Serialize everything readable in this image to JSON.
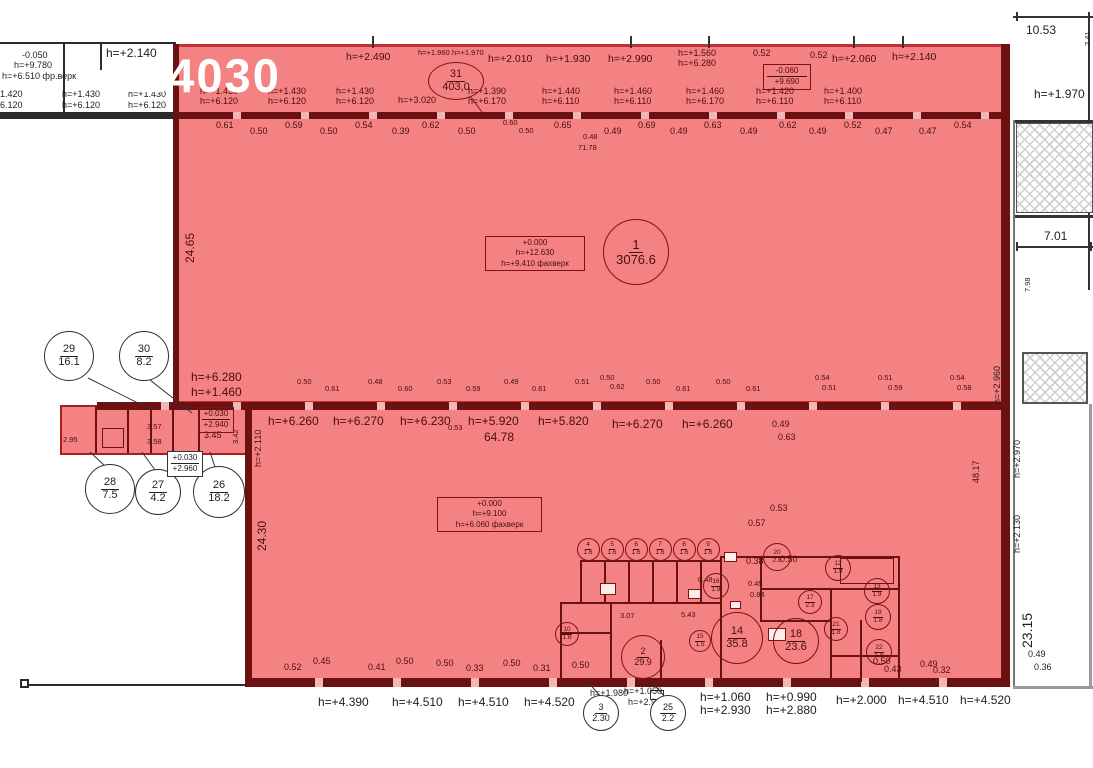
{
  "watermark": "224030",
  "colors": {
    "red_fill": "#f58282",
    "red_border": "#c43030",
    "wall_maroon": "#6b1111",
    "line_black": "#2b2b2b",
    "white": "#ffffff"
  },
  "rooms": [
    {
      "n": "31",
      "a": "403,0",
      "cx": 456,
      "cy": 81,
      "w": 56,
      "h": 38,
      "th": "r",
      "fs": "f11"
    },
    {
      "n": "1",
      "a": "3076.6",
      "cx": 636,
      "cy": 252,
      "w": 66,
      "h": 66,
      "th": "r",
      "fs": "f13"
    },
    {
      "n": "29",
      "a": "16.1",
      "cx": 69,
      "cy": 356,
      "w": 50,
      "h": 50,
      "th": "k",
      "fs": "f11"
    },
    {
      "n": "30",
      "a": "8.2",
      "cx": 144,
      "cy": 356,
      "w": 50,
      "h": 50,
      "th": "k",
      "fs": "f11"
    },
    {
      "n": "28",
      "a": "7.5",
      "cx": 110,
      "cy": 489,
      "w": 50,
      "h": 50,
      "th": "k",
      "fs": "f11"
    },
    {
      "n": "27",
      "a": "4.2",
      "cx": 158,
      "cy": 492,
      "w": 46,
      "h": 46,
      "th": "k",
      "fs": "f11"
    },
    {
      "n": "26",
      "a": "18.2",
      "cx": 219,
      "cy": 492,
      "w": 52,
      "h": 52,
      "th": "k",
      "fs": "f11"
    },
    {
      "n": "2",
      "a": "29.9",
      "cx": 643,
      "cy": 657,
      "w": 44,
      "h": 44,
      "th": "r",
      "fs": "f9"
    },
    {
      "n": "3",
      "a": "2.30",
      "cx": 601,
      "cy": 713,
      "w": 36,
      "h": 36,
      "th": "k",
      "fs": "f9"
    },
    {
      "n": "25",
      "a": "2.2",
      "cx": 668,
      "cy": 713,
      "w": 36,
      "h": 36,
      "th": "k",
      "fs": "f9"
    },
    {
      "n": "4",
      "a": "1.6",
      "cx": 588,
      "cy": 549,
      "w": 23,
      "h": 23,
      "th": "r",
      "fs": "f6"
    },
    {
      "n": "5",
      "a": "1.6",
      "cx": 612,
      "cy": 549,
      "w": 23,
      "h": 23,
      "th": "r",
      "fs": "f6"
    },
    {
      "n": "6",
      "a": "1.6",
      "cx": 636,
      "cy": 549,
      "w": 23,
      "h": 23,
      "th": "r",
      "fs": "f6"
    },
    {
      "n": "7",
      "a": "1.6",
      "cx": 660,
      "cy": 549,
      "w": 23,
      "h": 23,
      "th": "r",
      "fs": "f6"
    },
    {
      "n": "8",
      "a": "1.6",
      "cx": 684,
      "cy": 549,
      "w": 23,
      "h": 23,
      "th": "r",
      "fs": "f6"
    },
    {
      "n": "9",
      "a": "1.6",
      "cx": 708,
      "cy": 549,
      "w": 23,
      "h": 23,
      "th": "r",
      "fs": "f6"
    },
    {
      "n": "10",
      "a": "1.6",
      "cx": 567,
      "cy": 634,
      "w": 24,
      "h": 24,
      "th": "r",
      "fs": "f6"
    },
    {
      "n": "16",
      "a": "1.9",
      "cx": 716,
      "cy": 586,
      "w": 26,
      "h": 26,
      "th": "r",
      "fs": "f6"
    },
    {
      "n": "20",
      "a": "2.8",
      "cx": 777,
      "cy": 557,
      "w": 28,
      "h": 28,
      "th": "r",
      "fs": "f6"
    },
    {
      "n": "12",
      "a": "1.9",
      "cx": 838,
      "cy": 568,
      "w": 26,
      "h": 26,
      "th": "r",
      "fs": "f6"
    },
    {
      "n": "13",
      "a": "1.9",
      "cx": 877,
      "cy": 591,
      "w": 26,
      "h": 26,
      "th": "r",
      "fs": "f6"
    },
    {
      "n": "17",
      "a": "2.3",
      "cx": 810,
      "cy": 602,
      "w": 24,
      "h": 24,
      "th": "r",
      "fs": "f6"
    },
    {
      "n": "19",
      "a": "1.8",
      "cx": 878,
      "cy": 617,
      "w": 26,
      "h": 26,
      "th": "r",
      "fs": "f6"
    },
    {
      "n": "21",
      "a": "1.8",
      "cx": 836,
      "cy": 629,
      "w": 24,
      "h": 24,
      "th": "r",
      "fs": "f6"
    },
    {
      "n": "14",
      "a": "35.8",
      "cx": 737,
      "cy": 638,
      "w": 52,
      "h": 52,
      "th": "r",
      "fs": "f11"
    },
    {
      "n": "18",
      "a": "23.6",
      "cx": 796,
      "cy": 641,
      "w": 46,
      "h": 46,
      "th": "r",
      "fs": "f11"
    },
    {
      "n": "15",
      "a": "1.5",
      "cx": 700,
      "cy": 641,
      "w": 22,
      "h": 22,
      "th": "r",
      "fs": "f6"
    },
    {
      "n": "22",
      "a": "1.8",
      "cx": 879,
      "cy": 652,
      "w": 26,
      "h": 26,
      "th": "r",
      "fs": "f6"
    }
  ],
  "tag_boxes": [
    {
      "lines": [
        "+0.000",
        "h=+12.630",
        "h=+9.410 фахверк"
      ],
      "x": 485,
      "y": 236,
      "w": 100,
      "th": "r",
      "divided": false
    },
    {
      "lines": [
        "+0.000",
        "h=+9.100",
        "h=+6.060 фахверк"
      ],
      "x": 437,
      "y": 497,
      "w": 105,
      "th": "r",
      "divided": false
    },
    {
      "lines": [
        "-0.060",
        "+9.690"
      ],
      "x": 763,
      "y": 64,
      "w": 48,
      "th": "r",
      "divided": true
    },
    {
      "lines": [
        "+0.030",
        "+2.940"
      ],
      "x": 198,
      "y": 407,
      "w": 36,
      "th": "r",
      "divided": true
    },
    {
      "lines": [
        "+0.030",
        "+2.960"
      ],
      "x": 167,
      "y": 451,
      "w": 36,
      "th": "k",
      "divided": true
    }
  ],
  "annotations": [
    {
      "t": "-0.050",
      "x": 22,
      "y": 51,
      "c": "k",
      "s": "sm"
    },
    {
      "t": "h=+9.780",
      "x": 14,
      "y": 61,
      "c": "k",
      "s": "sm"
    },
    {
      "t": "h=+6.510 фр.верк",
      "x": 2,
      "y": 72,
      "c": "k",
      "s": "sm"
    },
    {
      "t": "h=+2.140",
      "x": 106,
      "y": 47,
      "c": "k",
      "s": "md"
    },
    {
      "t": "1.420",
      "x": 0,
      "y": 90,
      "c": "k",
      "s": "sm"
    },
    {
      "t": "6.120",
      "x": 0,
      "y": 101,
      "c": "k",
      "s": "sm"
    },
    {
      "t": "h=+1.430",
      "x": 62,
      "y": 90,
      "c": "k",
      "s": "sm"
    },
    {
      "t": "h=+6.120",
      "x": 62,
      "y": 101,
      "c": "k",
      "s": "sm"
    },
    {
      "t": "h=+1.430",
      "x": 128,
      "y": 90,
      "c": "k",
      "s": "sm"
    },
    {
      "t": "h=+6.120",
      "x": 128,
      "y": 101,
      "c": "k",
      "s": "sm"
    },
    {
      "t": "h=+2.490",
      "x": 346,
      "y": 52
    },
    {
      "t": "h=+1.960",
      "x": 418,
      "y": 49,
      "s": "xs"
    },
    {
      "t": "h=+1.970",
      "x": 452,
      "y": 49,
      "s": "xs"
    },
    {
      "t": "h=+2.010",
      "x": 488,
      "y": 54
    },
    {
      "t": "h=+1.930",
      "x": 546,
      "y": 54
    },
    {
      "t": "h=+2.990",
      "x": 608,
      "y": 54
    },
    {
      "t": "h=+1.560",
      "x": 678,
      "y": 49,
      "s": "sm"
    },
    {
      "t": "h=+6.280",
      "x": 678,
      "y": 59,
      "s": "sm"
    },
    {
      "t": "0.52",
      "x": 753,
      "y": 49,
      "s": "sm"
    },
    {
      "t": "0.52",
      "x": 810,
      "y": 51,
      "s": "sm"
    },
    {
      "t": "h=+2.060",
      "x": 832,
      "y": 54
    },
    {
      "t": "h=+2.140",
      "x": 892,
      "y": 52
    },
    {
      "t": "h=+1.430",
      "x": 200,
      "y": 87,
      "s": "sm"
    },
    {
      "t": "h=+6.120",
      "x": 200,
      "y": 97,
      "s": "sm"
    },
    {
      "t": "h=+1.430",
      "x": 268,
      "y": 87,
      "s": "sm"
    },
    {
      "t": "h=+6.120",
      "x": 268,
      "y": 97,
      "s": "sm"
    },
    {
      "t": "h=+1.430",
      "x": 336,
      "y": 87,
      "s": "sm"
    },
    {
      "t": "h=+6.120",
      "x": 336,
      "y": 97,
      "s": "sm"
    },
    {
      "t": "h=+3.020",
      "x": 398,
      "y": 96,
      "s": "sm"
    },
    {
      "t": "h=+1.390",
      "x": 468,
      "y": 87,
      "s": "sm"
    },
    {
      "t": "h=+6.170",
      "x": 468,
      "y": 97,
      "s": "sm"
    },
    {
      "t": "h=+1.440",
      "x": 542,
      "y": 87,
      "s": "sm"
    },
    {
      "t": "h=+6.110",
      "x": 542,
      "y": 97,
      "s": "sm"
    },
    {
      "t": "h=+1.460",
      "x": 614,
      "y": 87,
      "s": "sm"
    },
    {
      "t": "h=+6.110",
      "x": 614,
      "y": 97,
      "s": "sm"
    },
    {
      "t": "h=+1.460",
      "x": 686,
      "y": 87,
      "s": "sm"
    },
    {
      "t": "h=+6.170",
      "x": 686,
      "y": 97,
      "s": "sm"
    },
    {
      "t": "h=+1.420",
      "x": 756,
      "y": 87,
      "s": "sm"
    },
    {
      "t": "h=+6.110",
      "x": 756,
      "y": 97,
      "s": "sm"
    },
    {
      "t": "h=+1.400",
      "x": 824,
      "y": 87,
      "s": "sm"
    },
    {
      "t": "h=+6.110",
      "x": 824,
      "y": 97,
      "s": "sm"
    },
    {
      "t": "0.61",
      "x": 216,
      "y": 121,
      "s": "sm"
    },
    {
      "t": "0.50",
      "x": 250,
      "y": 127,
      "s": "sm"
    },
    {
      "t": "0.59",
      "x": 285,
      "y": 121,
      "s": "sm"
    },
    {
      "t": "0.50",
      "x": 320,
      "y": 127,
      "s": "sm"
    },
    {
      "t": "0.54",
      "x": 355,
      "y": 121,
      "s": "sm"
    },
    {
      "t": "0.39",
      "x": 392,
      "y": 127,
      "s": "sm"
    },
    {
      "t": "0.62",
      "x": 422,
      "y": 121,
      "s": "sm"
    },
    {
      "t": "0.50",
      "x": 458,
      "y": 127,
      "s": "sm"
    },
    {
      "t": "0.60",
      "x": 503,
      "y": 119,
      "s": "xs"
    },
    {
      "t": "0.50",
      "x": 519,
      "y": 127,
      "s": "xs"
    },
    {
      "t": "0.65",
      "x": 554,
      "y": 121,
      "s": "sm"
    },
    {
      "t": "0.49",
      "x": 604,
      "y": 127,
      "s": "sm"
    },
    {
      "t": "0.69",
      "x": 638,
      "y": 121,
      "s": "sm"
    },
    {
      "t": "0.49",
      "x": 670,
      "y": 127,
      "s": "sm"
    },
    {
      "t": "0.63",
      "x": 704,
      "y": 121,
      "s": "sm"
    },
    {
      "t": "0.49",
      "x": 740,
      "y": 127,
      "s": "sm"
    },
    {
      "t": "0.62",
      "x": 779,
      "y": 121,
      "s": "sm"
    },
    {
      "t": "0.49",
      "x": 809,
      "y": 127,
      "s": "sm"
    },
    {
      "t": "0.52",
      "x": 844,
      "y": 121,
      "s": "sm"
    },
    {
      "t": "0.47",
      "x": 875,
      "y": 127,
      "s": "sm"
    },
    {
      "t": "0.47",
      "x": 919,
      "y": 127,
      "s": "sm"
    },
    {
      "t": "0.54",
      "x": 954,
      "y": 121,
      "s": "sm"
    },
    {
      "t": "0.48",
      "x": 583,
      "y": 133,
      "s": "xs"
    },
    {
      "t": "71.78",
      "x": 578,
      "y": 144,
      "s": "xs"
    },
    {
      "t": "24.65",
      "x": 184,
      "y": 263,
      "s": "md",
      "r": 1
    },
    {
      "t": "10.53",
      "x": 1026,
      "y": 24,
      "c": "k",
      "s": "md"
    },
    {
      "t": "2.41",
      "x": 1084,
      "y": 46,
      "c": "k",
      "s": "xs",
      "r": 1
    },
    {
      "t": "h=+1.970",
      "x": 1034,
      "y": 88,
      "c": "k",
      "s": "md"
    },
    {
      "t": "7.01",
      "x": 1044,
      "y": 230,
      "c": "k",
      "s": "md"
    },
    {
      "t": "7.98",
      "x": 1024,
      "y": 292,
      "c": "k",
      "s": "xs",
      "r": 1
    },
    {
      "t": "h=+2.960",
      "x": 993,
      "y": 404,
      "c": "k",
      "s": "sm",
      "r": 1
    },
    {
      "t": "48.17",
      "x": 972,
      "y": 483,
      "s": "sm",
      "r": 1
    },
    {
      "t": "h=+2.970",
      "x": 1013,
      "y": 478,
      "c": "k",
      "s": "sm",
      "r": 1
    },
    {
      "t": "h=+2.130",
      "x": 1013,
      "y": 553,
      "c": "k",
      "s": "sm",
      "r": 1
    },
    {
      "t": "23.15",
      "x": 1020,
      "y": 648,
      "c": "k",
      "s": "lg",
      "r": 1
    },
    {
      "t": "0.49",
      "x": 1028,
      "y": 650,
      "c": "k",
      "s": "sm"
    },
    {
      "t": "0.36",
      "x": 1034,
      "y": 663,
      "c": "k",
      "s": "sm"
    },
    {
      "t": "h=+6.280",
      "x": 191,
      "y": 371,
      "s": "md"
    },
    {
      "t": "h=+1.460",
      "x": 191,
      "y": 386,
      "s": "md"
    },
    {
      "t": "0.50",
      "x": 297,
      "y": 378,
      "s": "xs"
    },
    {
      "t": "0.61",
      "x": 325,
      "y": 385,
      "s": "xs"
    },
    {
      "t": "0.48",
      "x": 368,
      "y": 378,
      "s": "xs"
    },
    {
      "t": "0.60",
      "x": 398,
      "y": 385,
      "s": "xs"
    },
    {
      "t": "0.53",
      "x": 437,
      "y": 378,
      "s": "xs"
    },
    {
      "t": "0.59",
      "x": 466,
      "y": 385,
      "s": "xs"
    },
    {
      "t": "0.49",
      "x": 504,
      "y": 378,
      "s": "xs"
    },
    {
      "t": "0.61",
      "x": 532,
      "y": 385,
      "s": "xs"
    },
    {
      "t": "0.51",
      "x": 575,
      "y": 378,
      "s": "xs"
    },
    {
      "t": "0.50",
      "x": 600,
      "y": 374,
      "s": "xs"
    },
    {
      "t": "0.62",
      "x": 610,
      "y": 383,
      "s": "xs"
    },
    {
      "t": "0.50",
      "x": 646,
      "y": 378,
      "s": "xs"
    },
    {
      "t": "0.61",
      "x": 676,
      "y": 385,
      "s": "xs"
    },
    {
      "t": "0.50",
      "x": 716,
      "y": 378,
      "s": "xs"
    },
    {
      "t": "0.61",
      "x": 746,
      "y": 385,
      "s": "xs"
    },
    {
      "t": "0.54",
      "x": 815,
      "y": 374,
      "s": "xs"
    },
    {
      "t": "0.51",
      "x": 822,
      "y": 384,
      "s": "xs"
    },
    {
      "t": "0.51",
      "x": 878,
      "y": 374,
      "s": "xs"
    },
    {
      "t": "0.59",
      "x": 888,
      "y": 384,
      "s": "xs"
    },
    {
      "t": "0.54",
      "x": 950,
      "y": 374,
      "s": "xs"
    },
    {
      "t": "0.58",
      "x": 957,
      "y": 384,
      "s": "xs"
    },
    {
      "t": "h=+2.110",
      "x": 254,
      "y": 467,
      "s": "sm",
      "r": 1
    },
    {
      "t": "h=+6.260",
      "x": 268,
      "y": 415,
      "s": "md"
    },
    {
      "t": "h=+6.270",
      "x": 333,
      "y": 415,
      "s": "md"
    },
    {
      "t": "h=+6.230",
      "x": 400,
      "y": 415,
      "s": "md"
    },
    {
      "t": "0.53",
      "x": 448,
      "y": 424,
      "s": "xs"
    },
    {
      "t": "h=+5.920",
      "x": 468,
      "y": 415,
      "s": "md"
    },
    {
      "t": "64.78",
      "x": 484,
      "y": 431,
      "s": "md"
    },
    {
      "t": "h=+5.820",
      "x": 538,
      "y": 415,
      "s": "md"
    },
    {
      "t": "h=+6.270",
      "x": 612,
      "y": 418,
      "s": "md"
    },
    {
      "t": "h=+6.260",
      "x": 682,
      "y": 418,
      "s": "md"
    },
    {
      "t": "0.49",
      "x": 772,
      "y": 420,
      "s": "sm"
    },
    {
      "t": "0.63",
      "x": 778,
      "y": 433,
      "s": "sm"
    },
    {
      "t": "2.95",
      "x": 63,
      "y": 436,
      "s": "xs"
    },
    {
      "t": "3.57",
      "x": 147,
      "y": 423,
      "s": "xs"
    },
    {
      "t": "3.58",
      "x": 147,
      "y": 438,
      "s": "xs"
    },
    {
      "t": "3.45",
      "x": 204,
      "y": 431,
      "s": "sm"
    },
    {
      "t": "3.42",
      "x": 232,
      "y": 444,
      "s": "xs",
      "r": 1
    },
    {
      "t": "24.30",
      "x": 256,
      "y": 551,
      "s": "md",
      "r": 1
    },
    {
      "t": "0.53",
      "x": 770,
      "y": 504,
      "s": "sm"
    },
    {
      "t": "0.57",
      "x": 748,
      "y": 519,
      "s": "sm"
    },
    {
      "t": "0.38",
      "x": 746,
      "y": 557,
      "s": "sm"
    },
    {
      "t": "0.50",
      "x": 780,
      "y": 555,
      "s": "sm"
    },
    {
      "t": "0.48",
      "x": 698,
      "y": 576,
      "s": "xs"
    },
    {
      "t": "0.45",
      "x": 748,
      "y": 580,
      "s": "xs"
    },
    {
      "t": "0.84",
      "x": 750,
      "y": 591,
      "s": "xs"
    },
    {
      "t": "3.07",
      "x": 620,
      "y": 612,
      "s": "xs"
    },
    {
      "t": "5.43",
      "x": 681,
      "y": 611,
      "s": "xs"
    },
    {
      "t": "0.52",
      "x": 284,
      "y": 663,
      "s": "sm"
    },
    {
      "t": "0.45",
      "x": 313,
      "y": 657,
      "s": "sm"
    },
    {
      "t": "0.41",
      "x": 368,
      "y": 663,
      "s": "sm"
    },
    {
      "t": "0.50",
      "x": 396,
      "y": 657,
      "s": "sm"
    },
    {
      "t": "0.50",
      "x": 436,
      "y": 659,
      "s": "sm"
    },
    {
      "t": "0.33",
      "x": 466,
      "y": 664,
      "s": "sm"
    },
    {
      "t": "0.50",
      "x": 503,
      "y": 659,
      "s": "sm"
    },
    {
      "t": "0.31",
      "x": 533,
      "y": 664,
      "s": "sm"
    },
    {
      "t": "0.50",
      "x": 572,
      "y": 661,
      "s": "sm"
    },
    {
      "t": "0.50",
      "x": 873,
      "y": 657,
      "s": "sm"
    },
    {
      "t": "0.43",
      "x": 884,
      "y": 665,
      "s": "sm"
    },
    {
      "t": "0.49",
      "x": 920,
      "y": 660,
      "s": "sm"
    },
    {
      "t": "0.32",
      "x": 933,
      "y": 666,
      "s": "sm"
    },
    {
      "t": "h=+4.390",
      "x": 318,
      "y": 696,
      "c": "k",
      "s": "md"
    },
    {
      "t": "h=+4.510",
      "x": 392,
      "y": 696,
      "c": "k",
      "s": "md"
    },
    {
      "t": "h=+4.510",
      "x": 458,
      "y": 696,
      "c": "k",
      "s": "md"
    },
    {
      "t": "h=+4.520",
      "x": 524,
      "y": 696,
      "c": "k",
      "s": "md"
    },
    {
      "t": "h=+1.980",
      "x": 590,
      "y": 689,
      "c": "k",
      "s": "sm"
    },
    {
      "t": "h=+1.050",
      "x": 624,
      "y": 687,
      "c": "k",
      "s": "sm"
    },
    {
      "t": "h=+2.920",
      "x": 628,
      "y": 698,
      "c": "k",
      "s": "sm"
    },
    {
      "t": "h=+1.060",
      "x": 700,
      "y": 691,
      "c": "k",
      "s": "md"
    },
    {
      "t": "h=+2.930",
      "x": 700,
      "y": 704,
      "c": "k",
      "s": "md"
    },
    {
      "t": "h=+0.990",
      "x": 766,
      "y": 691,
      "c": "k",
      "s": "md"
    },
    {
      "t": "h=+2.880",
      "x": 766,
      "y": 704,
      "c": "k",
      "s": "md"
    },
    {
      "t": "h=+2.000",
      "x": 836,
      "y": 694,
      "c": "k",
      "s": "md"
    },
    {
      "t": "h=+4.510",
      "x": 898,
      "y": 694,
      "c": "k",
      "s": "md"
    },
    {
      "t": "h=+4.520",
      "x": 960,
      "y": 694,
      "c": "k",
      "s": "md"
    }
  ]
}
